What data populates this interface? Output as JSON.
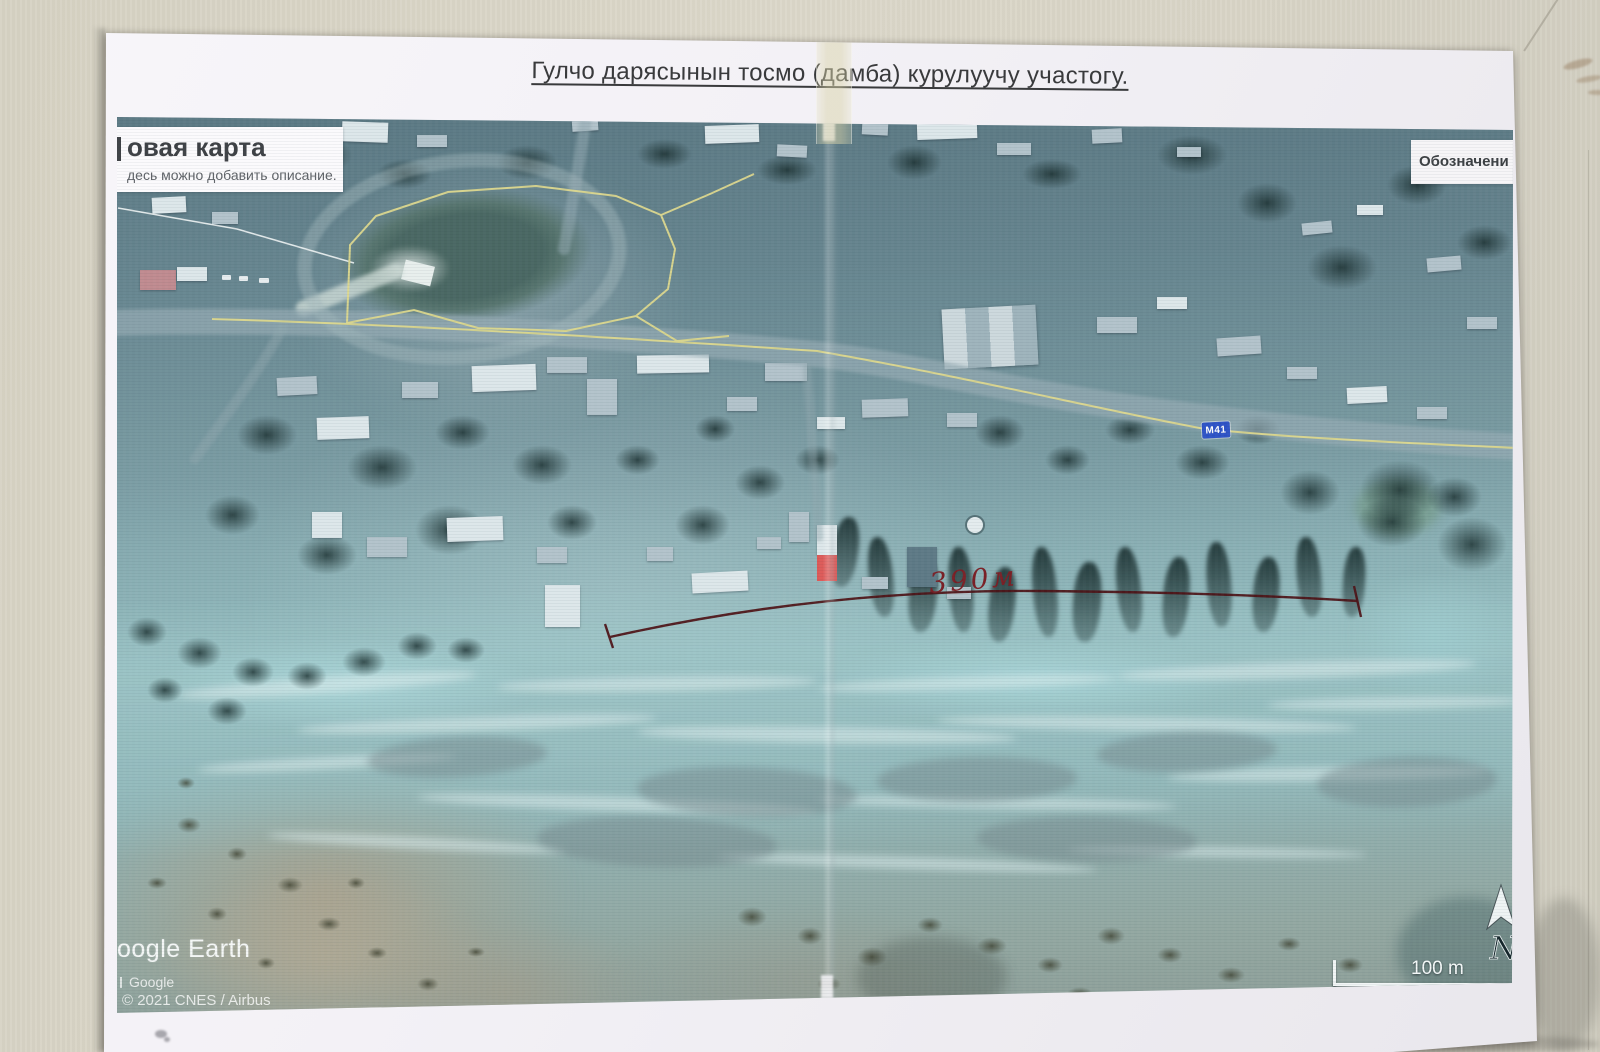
{
  "photo": {
    "sheet_title": "Гулчо дарясынын тосмо (дамба) курулуучу участогу."
  },
  "overlays": {
    "new_map_card": {
      "title": "овая карта",
      "subtitle": "десь можно добавить описание."
    },
    "legend_card": {
      "title": "Обозначени"
    },
    "road_badge": "М41",
    "measurement_label": "390м",
    "logo_text": "oogle Earth",
    "attribution": {
      "provider": "Google",
      "copyright": "© 2021 CNES / Airbus"
    },
    "scale_label": "100 m",
    "north_label": "N"
  },
  "colors": {
    "road_badge_bg": "#2e53c6",
    "measurement_line": "#4d1115",
    "route_highlight": "#ddd88e"
  }
}
